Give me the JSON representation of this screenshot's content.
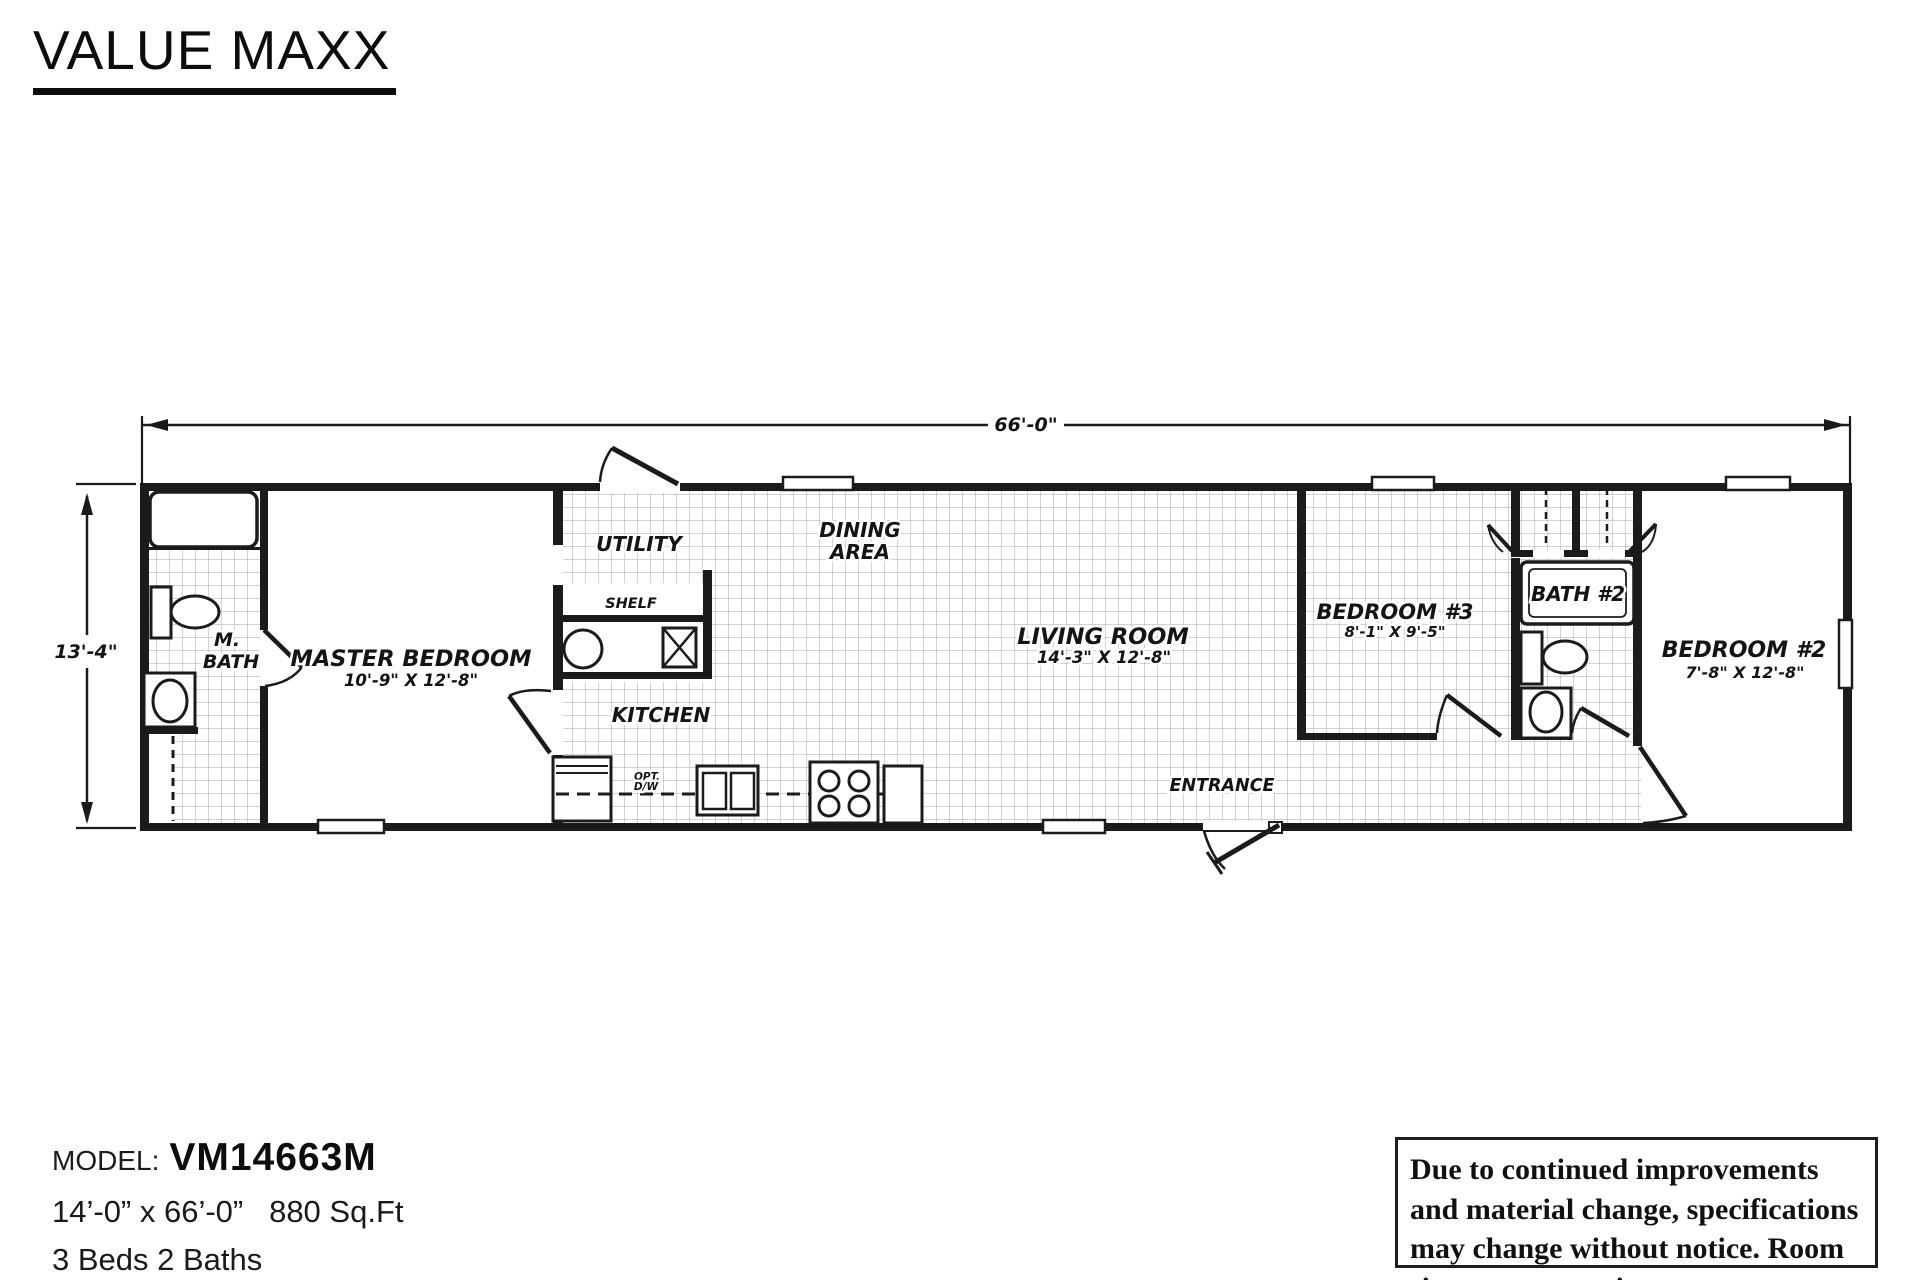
{
  "title": "VALUE MAXX",
  "plan": {
    "dim_width": "66'-0\"",
    "dim_height": "13'-4\"",
    "rooms": {
      "m_bath": {
        "line1": "M.",
        "line2": "BATH"
      },
      "master": {
        "name": "MASTER BEDROOM",
        "size": "10'-9\" X 12'-8\""
      },
      "utility": {
        "label": "UTILITY"
      },
      "shelf": {
        "label": "SHELF"
      },
      "dining": {
        "line1": "DINING",
        "line2": "AREA"
      },
      "kitchen": {
        "label": "KITCHEN"
      },
      "opt_dw": {
        "line1": "OPT.",
        "line2": "D/W"
      },
      "living": {
        "name": "LIVING ROOM",
        "size": "14'-3\" X 12'-8\""
      },
      "entrance": {
        "label": "ENTRANCE"
      },
      "bedroom3": {
        "name": "BEDROOM #3",
        "size": "8'-1\" X 9'-5\""
      },
      "bath2": {
        "label": "BATH #2"
      },
      "bedroom2": {
        "name": "BEDROOM #2",
        "size": "7'-8\" X 12'-8\""
      }
    }
  },
  "footer": {
    "model_label": "MODEL:",
    "model_number": "VM14663M",
    "dimensions": "14’-0” x 66’-0”   880 Sq.Ft",
    "beds_baths": "3 Beds 2 Baths",
    "disclaimer": "Due to continued improvements and material change, specifications may change without notice. Room sizes are approximate."
  }
}
